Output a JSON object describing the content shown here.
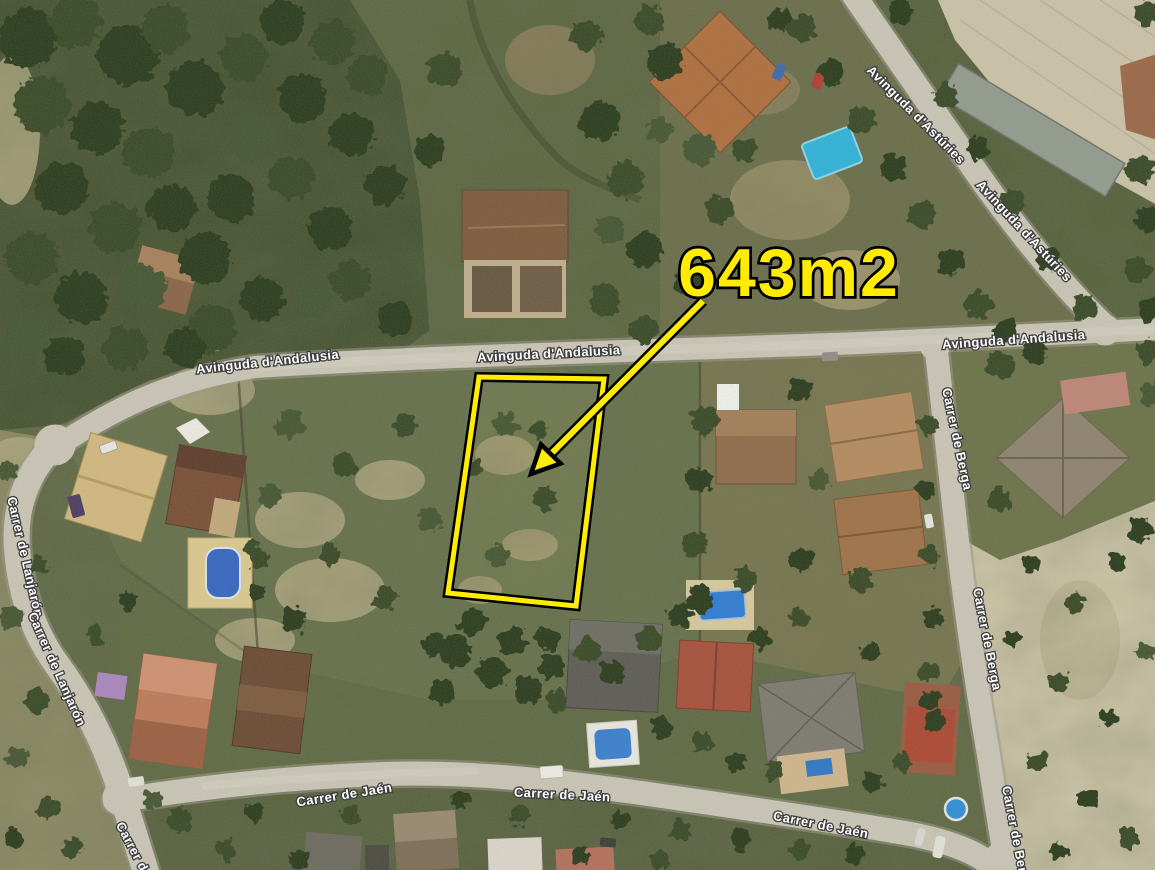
{
  "annotation": {
    "area_label": "643m2",
    "highlight_color": "#FFEC00"
  },
  "street_labels": {
    "andalusia": "Avinguda d'Andalusia",
    "asturies": "Avinguda d'Astúries",
    "berga": "Carrer de Berga",
    "lanjaron": "Carrer de Lanjarón",
    "jaen": "Carrer de Jaén",
    "partial_bottom_left": "Carrer de"
  },
  "label_style": {
    "fill": "#FFFFFF",
    "outline": "#3D3D3D"
  }
}
